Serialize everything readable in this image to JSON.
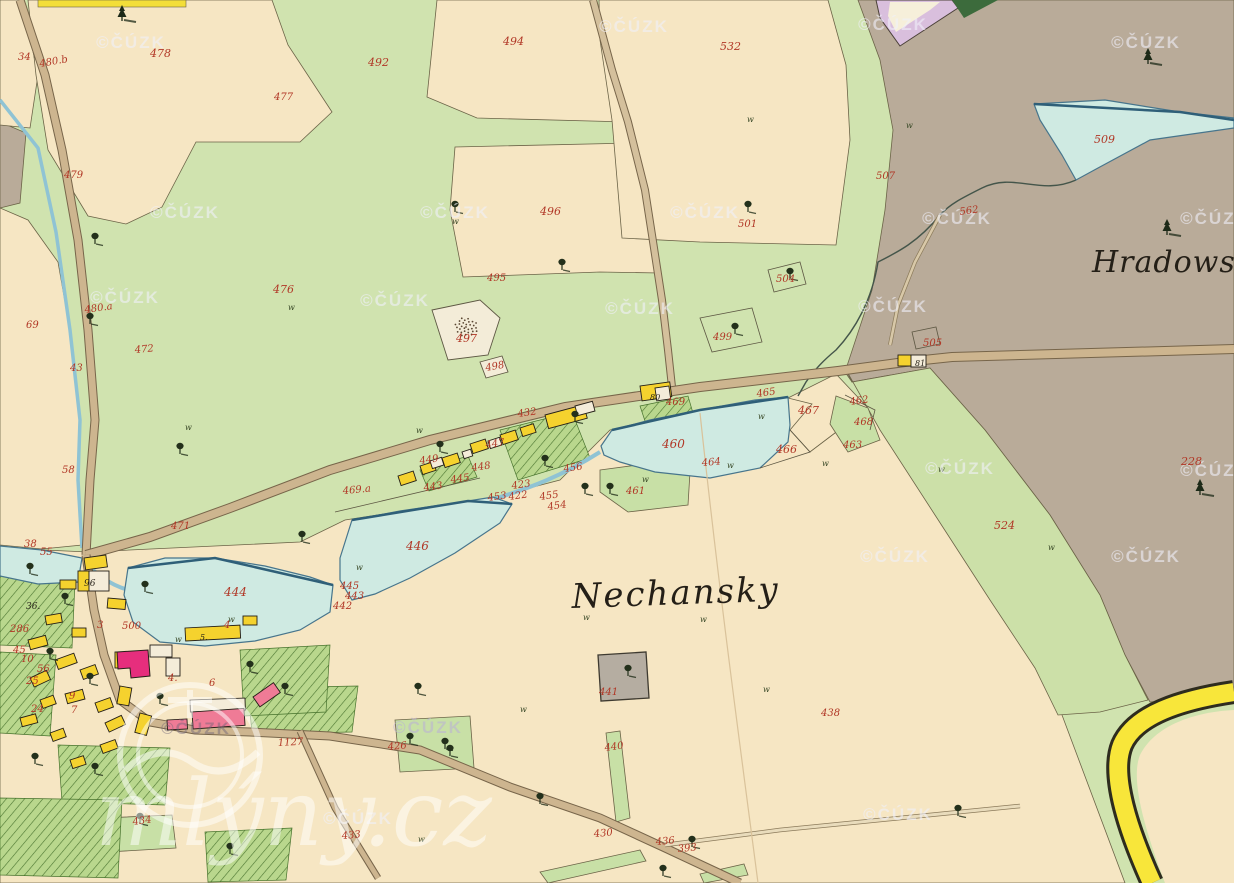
{
  "map": {
    "placenames": [
      {
        "text": "Nechansky"
      },
      {
        "text": "Hradowske"
      }
    ],
    "colors": {
      "field_cream": "#f6e6c3",
      "meadow_green": "#d0e3af",
      "pasture_gray": "#b9ab99",
      "water_blue": "#cfeae2",
      "road_brown": "#cdb58f",
      "building_yellow": "#f5d22e",
      "building_pink": "#ef7b96",
      "building_magenta": "#e62e7d",
      "label_red": "#b13726",
      "border_yellow": "#f8e63a"
    },
    "parcel_labels": [
      {
        "t": "34",
        "x": 18,
        "y": 60
      },
      {
        "t": "480.b",
        "x": 40,
        "y": 67,
        "r": -10
      },
      {
        "t": "478",
        "x": 150,
        "y": 57,
        "s": 11
      },
      {
        "t": "477",
        "x": 274,
        "y": 100
      },
      {
        "t": "479",
        "x": 64,
        "y": 178
      },
      {
        "t": "492",
        "x": 368,
        "y": 66,
        "s": 11
      },
      {
        "t": "494",
        "x": 503,
        "y": 45,
        "s": 11
      },
      {
        "t": "532",
        "x": 720,
        "y": 50,
        "s": 11
      },
      {
        "t": "496",
        "x": 540,
        "y": 215,
        "s": 11
      },
      {
        "t": "495",
        "x": 487,
        "y": 281
      },
      {
        "t": "476",
        "x": 273,
        "y": 293,
        "s": 11
      },
      {
        "t": "480.a",
        "x": 85,
        "y": 313,
        "r": -8
      },
      {
        "t": "69",
        "x": 26,
        "y": 328
      },
      {
        "t": "472",
        "x": 135,
        "y": 353,
        "r": -5
      },
      {
        "t": "43",
        "x": 70,
        "y": 371
      },
      {
        "t": "497",
        "x": 456,
        "y": 342,
        "s": 11
      },
      {
        "t": "498",
        "x": 486,
        "y": 371,
        "r": -10
      },
      {
        "t": "501",
        "x": 738,
        "y": 227
      },
      {
        "t": "507",
        "x": 876,
        "y": 179
      },
      {
        "t": "562",
        "x": 960,
        "y": 215,
        "r": -8
      },
      {
        "t": "509",
        "x": 1094,
        "y": 143,
        "s": 11
      },
      {
        "t": "504",
        "x": 776,
        "y": 282
      },
      {
        "t": "499",
        "x": 713,
        "y": 340
      },
      {
        "t": "505",
        "x": 923,
        "y": 346
      },
      {
        "t": "228",
        "x": 1181,
        "y": 465,
        "s": 11
      },
      {
        "t": "524",
        "x": 994,
        "y": 529,
        "s": 11
      },
      {
        "t": "469",
        "x": 666,
        "y": 405
      },
      {
        "t": "467",
        "x": 798,
        "y": 414,
        "s": 11
      },
      {
        "t": "465",
        "x": 757,
        "y": 397,
        "r": -8
      },
      {
        "t": "462",
        "x": 850,
        "y": 405,
        "r": -8
      },
      {
        "t": "468",
        "x": 854,
        "y": 425
      },
      {
        "t": "463",
        "x": 843,
        "y": 448
      },
      {
        "t": "460",
        "x": 662,
        "y": 448,
        "s": 12
      },
      {
        "t": "466",
        "x": 776,
        "y": 453,
        "s": 11
      },
      {
        "t": "464",
        "x": 702,
        "y": 466,
        "r": -5
      },
      {
        "t": "461",
        "x": 626,
        "y": 494
      },
      {
        "t": "469.a",
        "x": 343,
        "y": 494,
        "r": -5
      },
      {
        "t": "432",
        "x": 518,
        "y": 417,
        "r": -8
      },
      {
        "t": "447",
        "x": 486,
        "y": 448,
        "r": -8
      },
      {
        "t": "449",
        "x": 420,
        "y": 464,
        "r": -8
      },
      {
        "t": "456",
        "x": 564,
        "y": 472,
        "r": -8
      },
      {
        "t": "448",
        "x": 472,
        "y": 471,
        "r": -8
      },
      {
        "t": "445",
        "x": 451,
        "y": 483,
        "r": -8
      },
      {
        "t": "423",
        "x": 512,
        "y": 489,
        "r": -8
      },
      {
        "t": "443",
        "x": 424,
        "y": 491,
        "r": -8
      },
      {
        "t": "453",
        "x": 488,
        "y": 501,
        "r": -8
      },
      {
        "t": "422",
        "x": 509,
        "y": 500,
        "r": -8
      },
      {
        "t": "455",
        "x": 540,
        "y": 500,
        "r": -8
      },
      {
        "t": "454",
        "x": 548,
        "y": 510,
        "r": -8
      },
      {
        "t": "446",
        "x": 406,
        "y": 550,
        "s": 12
      },
      {
        "t": "445",
        "x": 340,
        "y": 589
      },
      {
        "t": "443",
        "x": 345,
        "y": 599
      },
      {
        "t": "442",
        "x": 333,
        "y": 609
      },
      {
        "t": "444",
        "x": 224,
        "y": 596,
        "s": 12
      },
      {
        "t": "471",
        "x": 171,
        "y": 529
      },
      {
        "t": "58",
        "x": 62,
        "y": 473
      },
      {
        "t": "38",
        "x": 24,
        "y": 547
      },
      {
        "t": "55",
        "x": 40,
        "y": 555
      },
      {
        "t": "56",
        "x": 37,
        "y": 672
      },
      {
        "t": "286",
        "x": 10,
        "y": 632
      },
      {
        "t": "3",
        "x": 97,
        "y": 628
      },
      {
        "t": "500",
        "x": 122,
        "y": 629
      },
      {
        "t": "4",
        "x": 224,
        "y": 628
      },
      {
        "t": "45",
        "x": 13,
        "y": 653
      },
      {
        "t": "10",
        "x": 21,
        "y": 662
      },
      {
        "t": "25",
        "x": 26,
        "y": 684
      },
      {
        "t": "9",
        "x": 69,
        "y": 699
      },
      {
        "t": "7",
        "x": 71,
        "y": 713
      },
      {
        "t": "24",
        "x": 31,
        "y": 712
      },
      {
        "t": "4.",
        "x": 168,
        "y": 681
      },
      {
        "t": "6",
        "x": 209,
        "y": 686
      },
      {
        "t": "434",
        "x": 133,
        "y": 825,
        "r": -8
      },
      {
        "t": "433",
        "x": 342,
        "y": 839,
        "r": -5
      },
      {
        "t": "438",
        "x": 821,
        "y": 716
      },
      {
        "t": "441",
        "x": 599,
        "y": 695
      },
      {
        "t": "440",
        "x": 605,
        "y": 751,
        "r": -8
      },
      {
        "t": "1127",
        "x": 278,
        "y": 746,
        "r": -3
      },
      {
        "t": "426",
        "x": 388,
        "y": 750,
        "r": -5
      },
      {
        "t": "430",
        "x": 594,
        "y": 837,
        "r": -5
      },
      {
        "t": "436",
        "x": 656,
        "y": 845,
        "r": -5
      },
      {
        "t": "393",
        "x": 678,
        "y": 852,
        "r": -5
      }
    ],
    "house_numbers": [
      {
        "t": "96",
        "x": 84,
        "y": 586
      },
      {
        "t": "36.",
        "x": 26,
        "y": 609
      },
      {
        "t": "80",
        "x": 650,
        "y": 400,
        "s": 8
      },
      {
        "t": "81",
        "x": 915,
        "y": 366,
        "s": 8
      },
      {
        "t": "5.",
        "x": 200,
        "y": 640,
        "s": 8
      }
    ],
    "grass_mark_glyph": "w",
    "grass_marks": [
      [
        288,
        310
      ],
      [
        452,
        224
      ],
      [
        747,
        122
      ],
      [
        758,
        419
      ],
      [
        642,
        482
      ],
      [
        727,
        468
      ],
      [
        822,
        466
      ],
      [
        1048,
        550
      ],
      [
        416,
        433
      ],
      [
        356,
        570
      ],
      [
        228,
        622
      ],
      [
        520,
        712
      ],
      [
        418,
        842
      ],
      [
        906,
        128
      ],
      [
        938,
        472
      ],
      [
        700,
        622
      ],
      [
        583,
        620
      ],
      [
        175,
        642
      ],
      [
        763,
        692
      ],
      [
        185,
        430
      ]
    ],
    "watermark": {
      "text": "©ČÚZK",
      "site": "mlýny.cz",
      "positions": [
        {
          "x": 131,
          "y": 48
        },
        {
          "x": 634,
          "y": 32
        },
        {
          "x": 893,
          "y": 30
        },
        {
          "x": 1146,
          "y": 48
        },
        {
          "x": 185,
          "y": 218
        },
        {
          "x": 455,
          "y": 218
        },
        {
          "x": 705,
          "y": 218
        },
        {
          "x": 957,
          "y": 224
        },
        {
          "x": 1215,
          "y": 224
        },
        {
          "x": 125,
          "y": 303
        },
        {
          "x": 395,
          "y": 306
        },
        {
          "x": 640,
          "y": 314
        },
        {
          "x": 893,
          "y": 312
        },
        {
          "x": 960,
          "y": 474
        },
        {
          "x": 1215,
          "y": 476
        },
        {
          "x": 895,
          "y": 562
        },
        {
          "x": 1146,
          "y": 562
        },
        {
          "x": 196,
          "y": 734,
          "tone": "dark"
        },
        {
          "x": 428,
          "y": 733,
          "tone": "lav"
        },
        {
          "x": 358,
          "y": 824
        },
        {
          "x": 898,
          "y": 820
        }
      ]
    }
  }
}
